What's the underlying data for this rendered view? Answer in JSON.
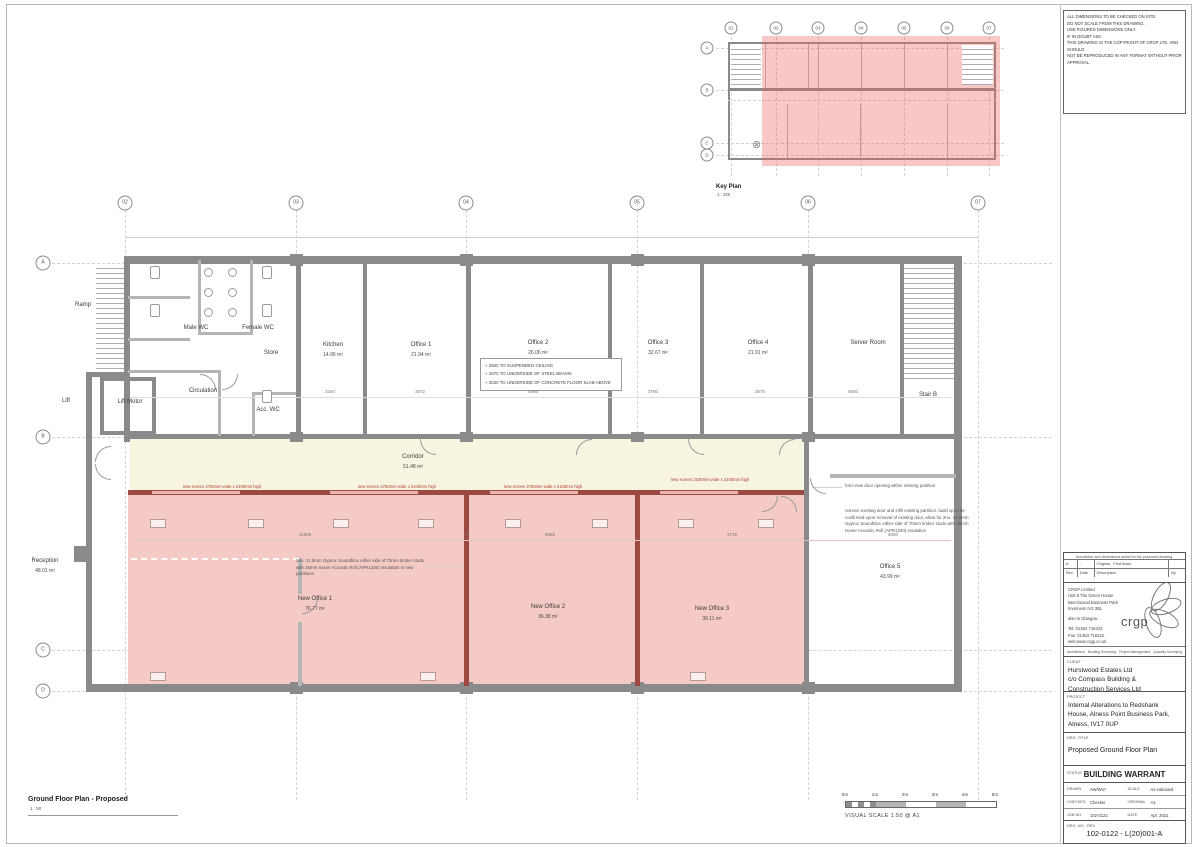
{
  "sheet": {
    "notes": [
      "ALL DIMENSIONS TO BE CHECKED ON SITE.",
      "DO NOT SCALE FROM THIS DRAWING.",
      "USE FIGURED DIMENSIONS ONLY.",
      "IF IN DOUBT ASK.",
      "THIS DRAWING IS THE COPYRIGHT OF CRGP LTD. AND SHOULD",
      "NOT BE REPRODUCED IN ANY FORMAT WITHOUT PRIOR",
      "APPROVAL."
    ]
  },
  "key_plan": {
    "title": "Key Plan",
    "scale": "1 : 200",
    "cols": [
      "01",
      "02",
      "03",
      "04",
      "05",
      "06",
      "07"
    ],
    "rows": [
      "A",
      "B",
      "C",
      "D"
    ]
  },
  "plan": {
    "cols": [
      "02",
      "03",
      "04",
      "05",
      "06",
      "07"
    ],
    "rows": [
      "A",
      "B",
      "C",
      "D"
    ],
    "caption_title": "Ground Floor Plan - Proposed",
    "caption_scale": "1 : 50",
    "rooms": [
      {
        "name": "Ramp",
        "area": ""
      },
      {
        "name": "Male WC",
        "area": ""
      },
      {
        "name": "Female WC",
        "area": ""
      },
      {
        "name": "Store",
        "area": ""
      },
      {
        "name": "Circulation",
        "area": ""
      },
      {
        "name": "Lift Motor",
        "area": ""
      },
      {
        "name": "Lift",
        "area": ""
      },
      {
        "name": "Acc. WC",
        "area": ""
      },
      {
        "name": "Kitchen",
        "area": "14.06 m²"
      },
      {
        "name": "Office 1",
        "area": "21.94 m²"
      },
      {
        "name": "Office 2",
        "area": "26.06 m²"
      },
      {
        "name": "Office 3",
        "area": "32.67 m²"
      },
      {
        "name": "Office 4",
        "area": "21.91 m²"
      },
      {
        "name": "Server Room",
        "area": ""
      },
      {
        "name": "Stair B",
        "area": ""
      },
      {
        "name": "Corridor",
        "area": "51.48 m²"
      },
      {
        "name": "New Office 1",
        "area": "76.77 m²"
      },
      {
        "name": "New Office 2",
        "area": "36.38 m²"
      },
      {
        "name": "New Office 3",
        "area": "36.11 m²"
      },
      {
        "name": "Office 5",
        "area": "43.99 m²"
      },
      {
        "name": "Reception",
        "area": "48.01 m²"
      }
    ],
    "screen_notes": [
      "new screen 2750mm wide x 2100mm high",
      "new screen 2750mm wide x 2100mm high",
      "new screen 2750mm wide x 2100mm high",
      "new screen 2100mm wide x 2100mm high"
    ],
    "ceiling_notes": [
      "+ 2650 TO SUSPENDED CEILING",
      "+ 2970 TO UNDERSIDE OF STEEL BEAMS",
      "+ 3530 TO UNDERSIDE OF CONCRETE FLOOR SLAB ABOVE"
    ],
    "partition_note": "2no. 12.5mm Gyproc Soundbloc either side of 70mm timber studs with 25mm Isover Acoustic Roll (APR1200) insulation in new partitions",
    "door_note": "form new door opening within existing partition",
    "infill_note": "remove existing door and infill existing partition. build up to be confirmed upon removal of existing door, allow for 2no. 12.5mm Gyproc Soundbloc either side of 70mm timber studs with 25mm Isover Acoustic Roll (APR1200) insulation",
    "dims_top": [
      "3340",
      "3672",
      "4966",
      "3790",
      "3675",
      "5920"
    ],
    "dims_bottom": [
      "11905",
      "75",
      "5685",
      "3715",
      "5050"
    ]
  },
  "scale_bar": {
    "labels": [
      "0m",
      "1m",
      "2m",
      "3m",
      "4m",
      "5m"
    ],
    "caption": "VISUAL SCALE 1:50 @ A1"
  },
  "title_block": {
    "revision_note": "Annotation and dimensions added to the proposed drawing.",
    "revision_row": {
      "rev": "A",
      "date": "-",
      "description": "Original - First Issue",
      "by": ""
    },
    "revision_header": {
      "rev": "Rev.",
      "date": "Date",
      "description": "Description",
      "by": "By"
    },
    "company": {
      "line1": "CRGP Limited",
      "line2": "Unit 8 The Green House",
      "line3": "Beechwood Business Park",
      "line4": "Inverness IV2 3BL",
      "also": "also in Glasgow",
      "tel": "Tel: 01463 718233",
      "fax": "Fax: 01463 718222",
      "web": "web:www.crgp.co.uk",
      "logo": "crgp",
      "svc1": "Architecture",
      "svc2": "Building Surveying",
      "svc3": "Project Management",
      "svc4": "Quantity Surveying"
    },
    "client_label": "CLIENT",
    "client1": "Hurstwood Estates Ltd",
    "client2": "c/o Compass Building &",
    "client3": "Construction Services Ltd",
    "project_label": "PROJECT",
    "project1": "Internal Alterations to Redshank",
    "project2": "House, Alness Point Business Park,",
    "project3": "Alness, IV17 0UP",
    "drg_title_label": "DRG. TITLE",
    "drg_title": "Proposed Ground Floor Plan",
    "status_label": "STATUS",
    "status": "BUILDING WARRANT",
    "fields": {
      "drawn_label": "DRAWN",
      "drawn": "AW/WVI",
      "scale_label": "SCALE",
      "scale": "As indicated",
      "checked_label": "CHECKED",
      "checked": "Checker",
      "original_label": "ORIGINAL",
      "original": "A1",
      "job_label": "JOB NO.",
      "job": "102-0122",
      "date_label": "DATE",
      "date": "Apr. 2021"
    },
    "drg_no_label": "DRG. NO. -REV",
    "drg_no": "102-0122 - L(20)001-A"
  },
  "colors": {
    "highlight_pink": "#f5c9c5",
    "corridor_cream": "#f7f4e0",
    "new_wall_red": "#9c4a41",
    "screen_text_red": "#b03a30",
    "wall_gray": "#8a8a8a"
  }
}
